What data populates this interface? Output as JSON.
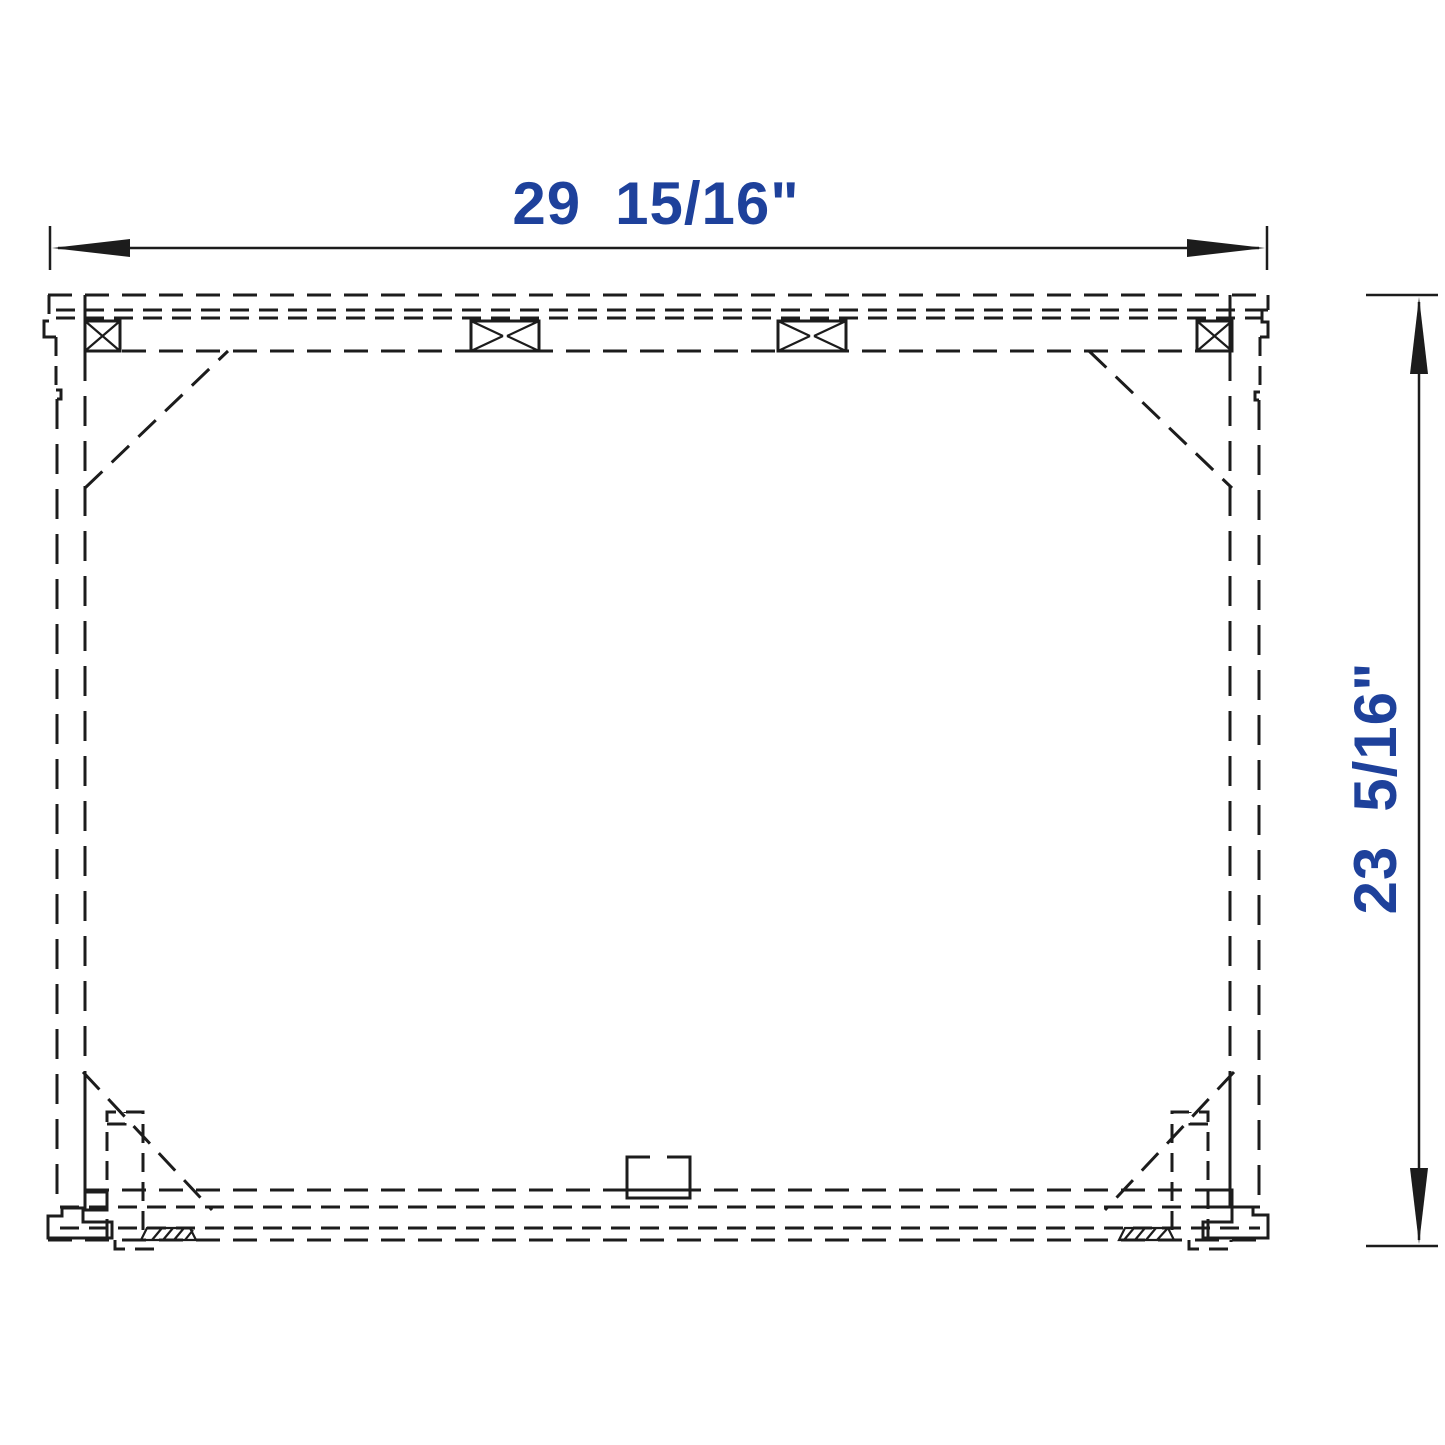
{
  "drawing": {
    "kind": "cabinet-frame-plan-view",
    "line_color": "#1c1c1c",
    "background_color": "#ffffff",
    "dimension_text_color": "#1e419b"
  },
  "dimensions": {
    "width": {
      "whole": "29",
      "fraction": "15/16\"",
      "full": "29 15/16\""
    },
    "height": {
      "whole": "23",
      "fraction": "5/16\"",
      "full": "23 5/16\""
    }
  }
}
